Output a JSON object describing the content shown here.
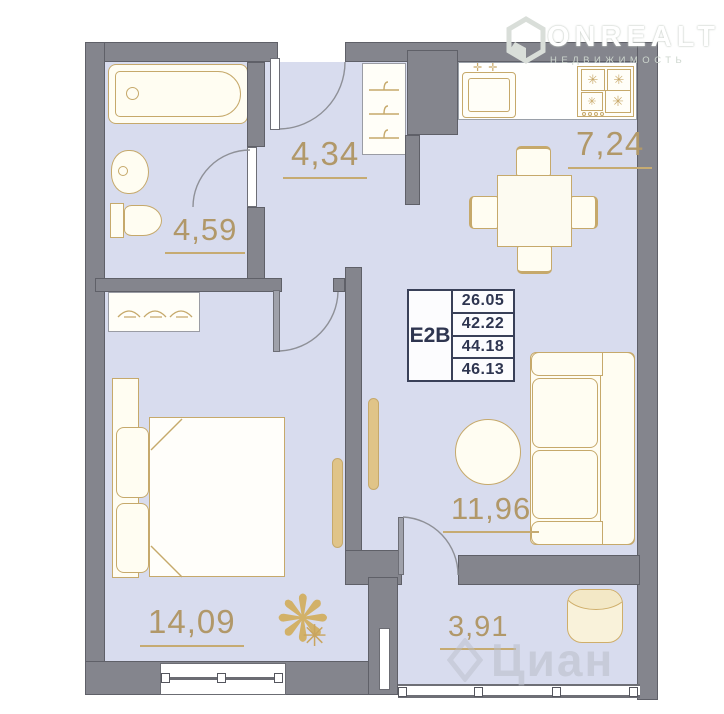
{
  "logo": {
    "brand": "ONREALT",
    "tagline": "НЕДВИЖИМОСТЬ"
  },
  "plan": {
    "code": "E2B",
    "areas": [
      "26.05",
      "42.22",
      "44.18",
      "46.13"
    ]
  },
  "rooms": {
    "hallway": {
      "label": "4,34"
    },
    "kitchen": {
      "label": "7,24"
    },
    "bathroom": {
      "label": "4,59"
    },
    "bedroom": {
      "label": "14,09"
    },
    "living": {
      "label": "11,96"
    },
    "balcony": {
      "label": "3,91"
    }
  },
  "watermark": {
    "text": "Циан"
  },
  "icons": {
    "plant": "❋",
    "plant_small": "✳",
    "burner": "✳",
    "faucet": "✛"
  },
  "colors": {
    "wall": "#84858d",
    "floor": "#d8dcee",
    "furniture_outline": "#c6a96b",
    "room_label": "#b19869",
    "info_text": "#2e3550"
  }
}
